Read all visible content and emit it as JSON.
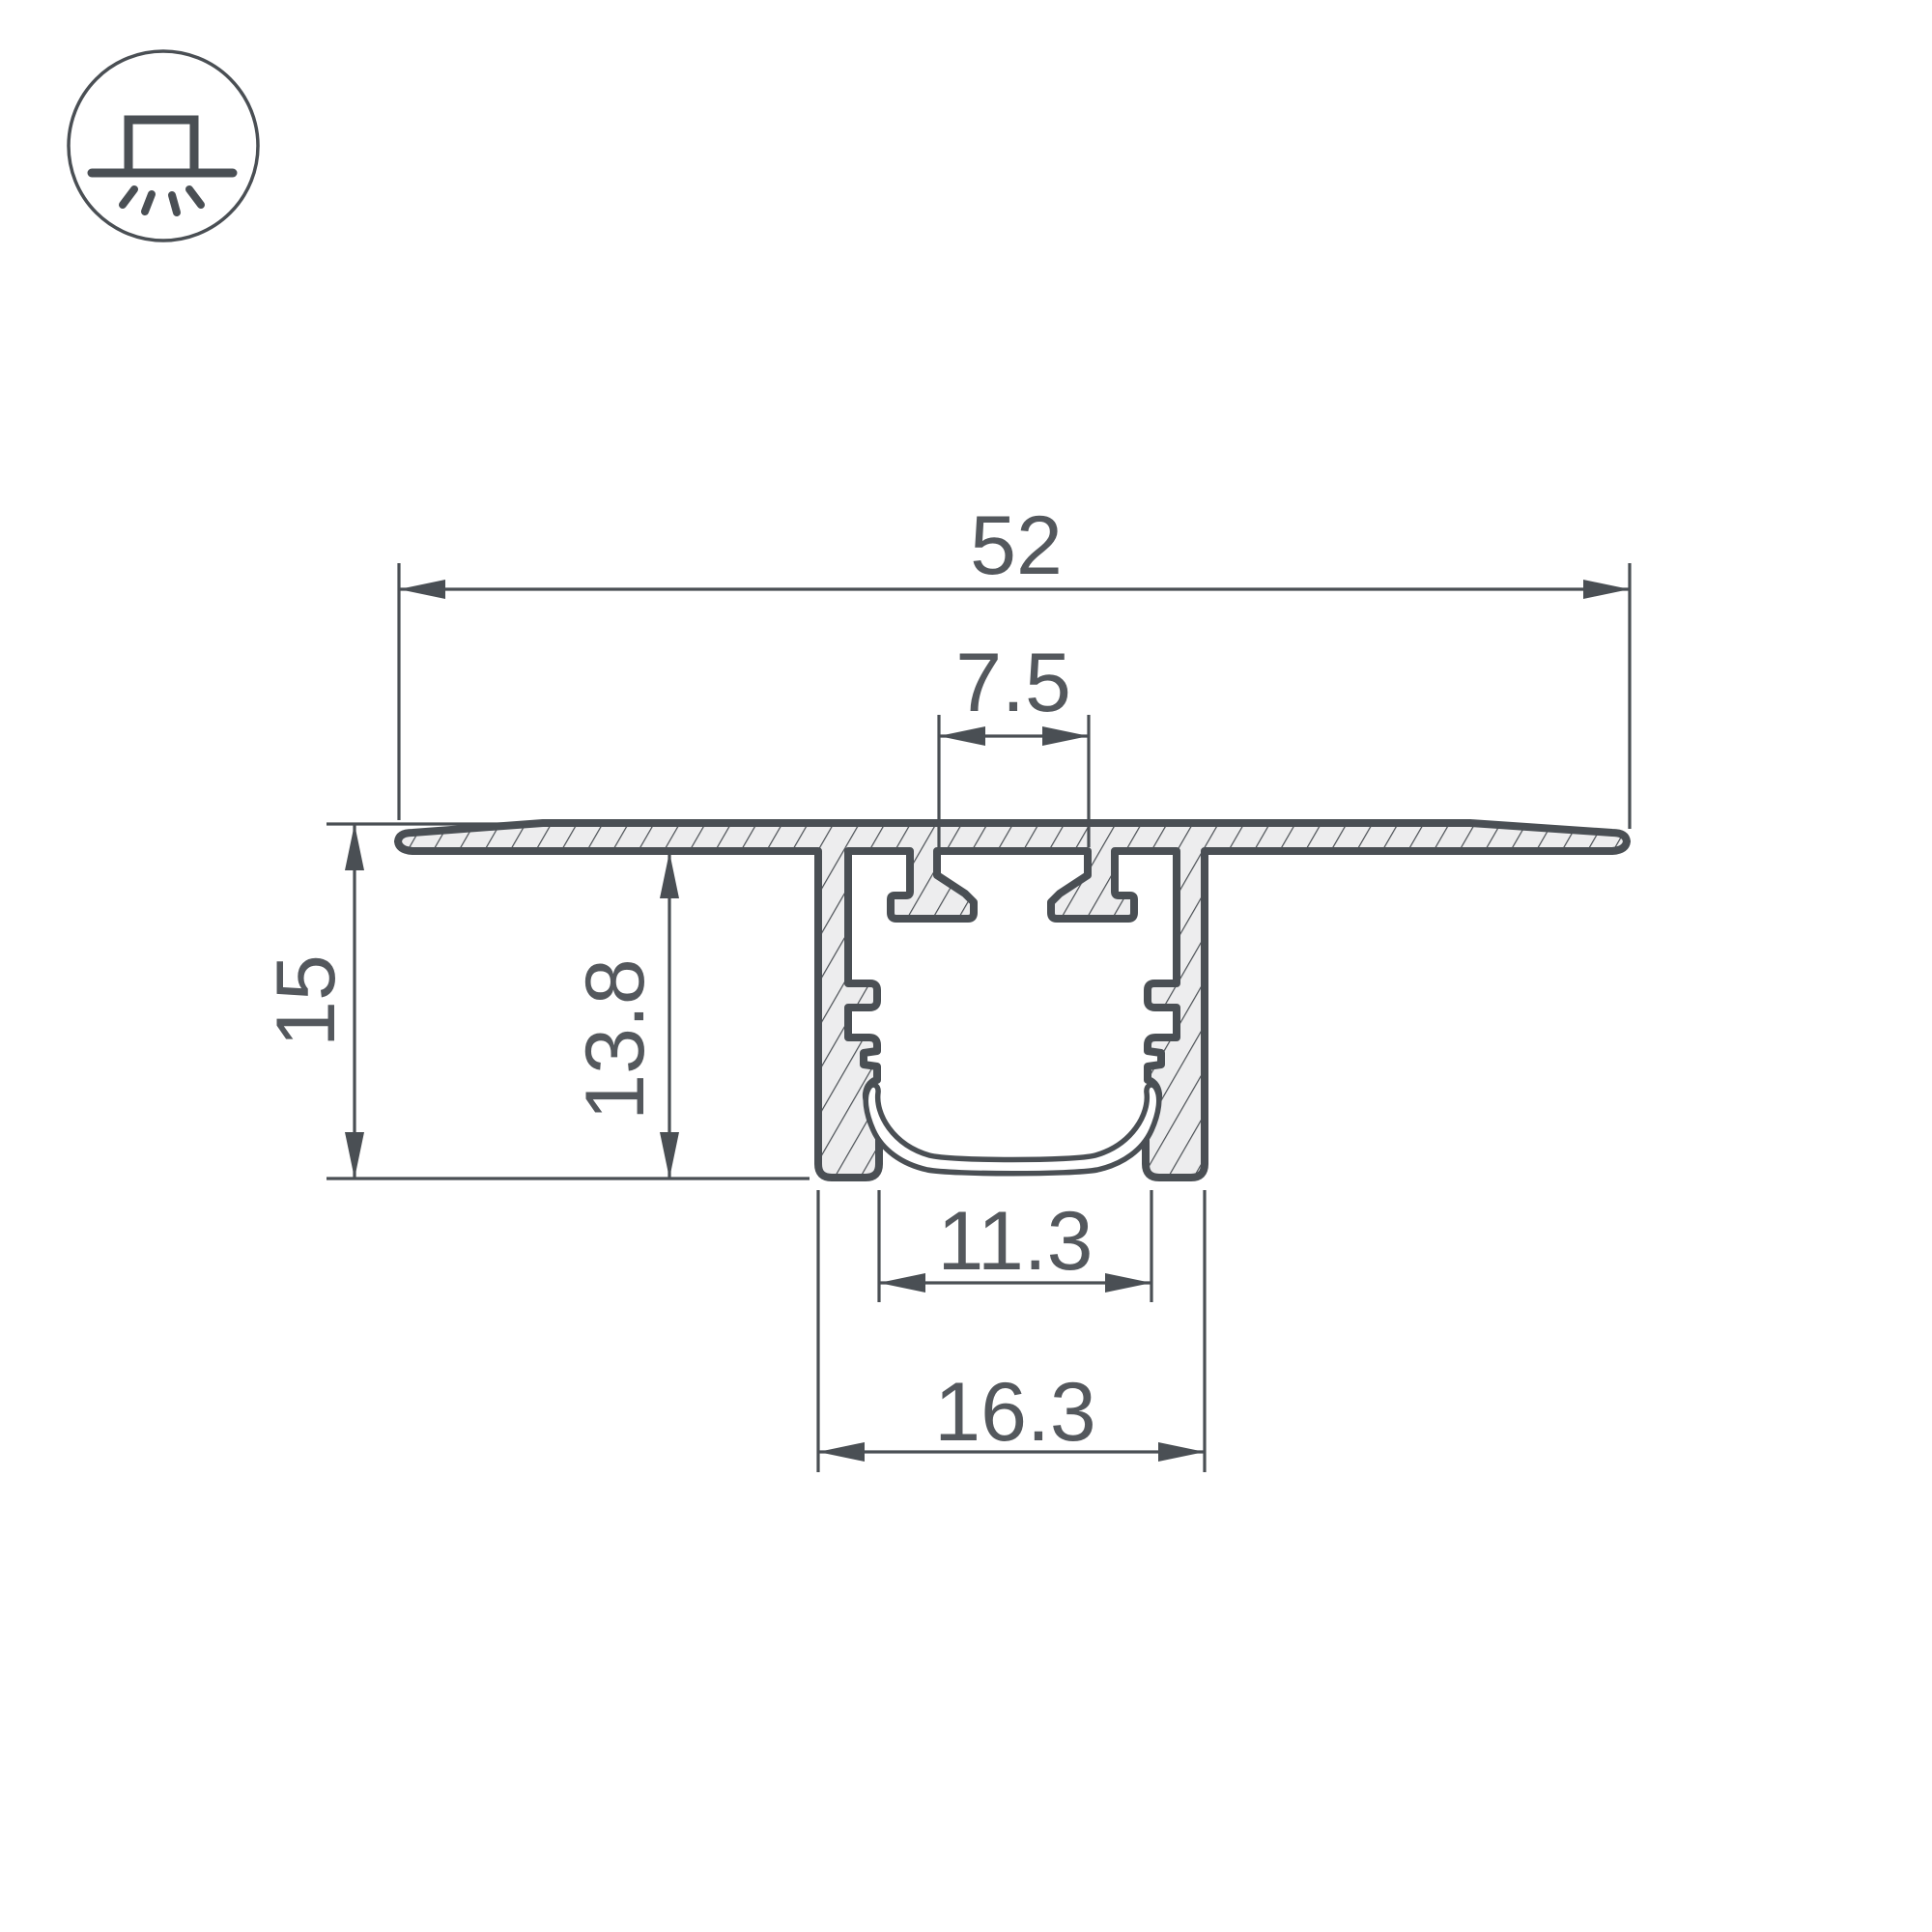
{
  "drawing": {
    "type": "led-profile-cross-section",
    "icon": "recessed-mount-light-icon",
    "dimensions": {
      "flange_width": "52",
      "top_slot_width": "7.5",
      "total_height": "15",
      "inner_height": "13.8",
      "inner_width": "11.3",
      "outer_width": "16.3"
    },
    "colors": {
      "outline": "#4A4F54",
      "fill": "#EDEDEE",
      "label": "#54585D",
      "background": "#FFFFFF"
    }
  }
}
